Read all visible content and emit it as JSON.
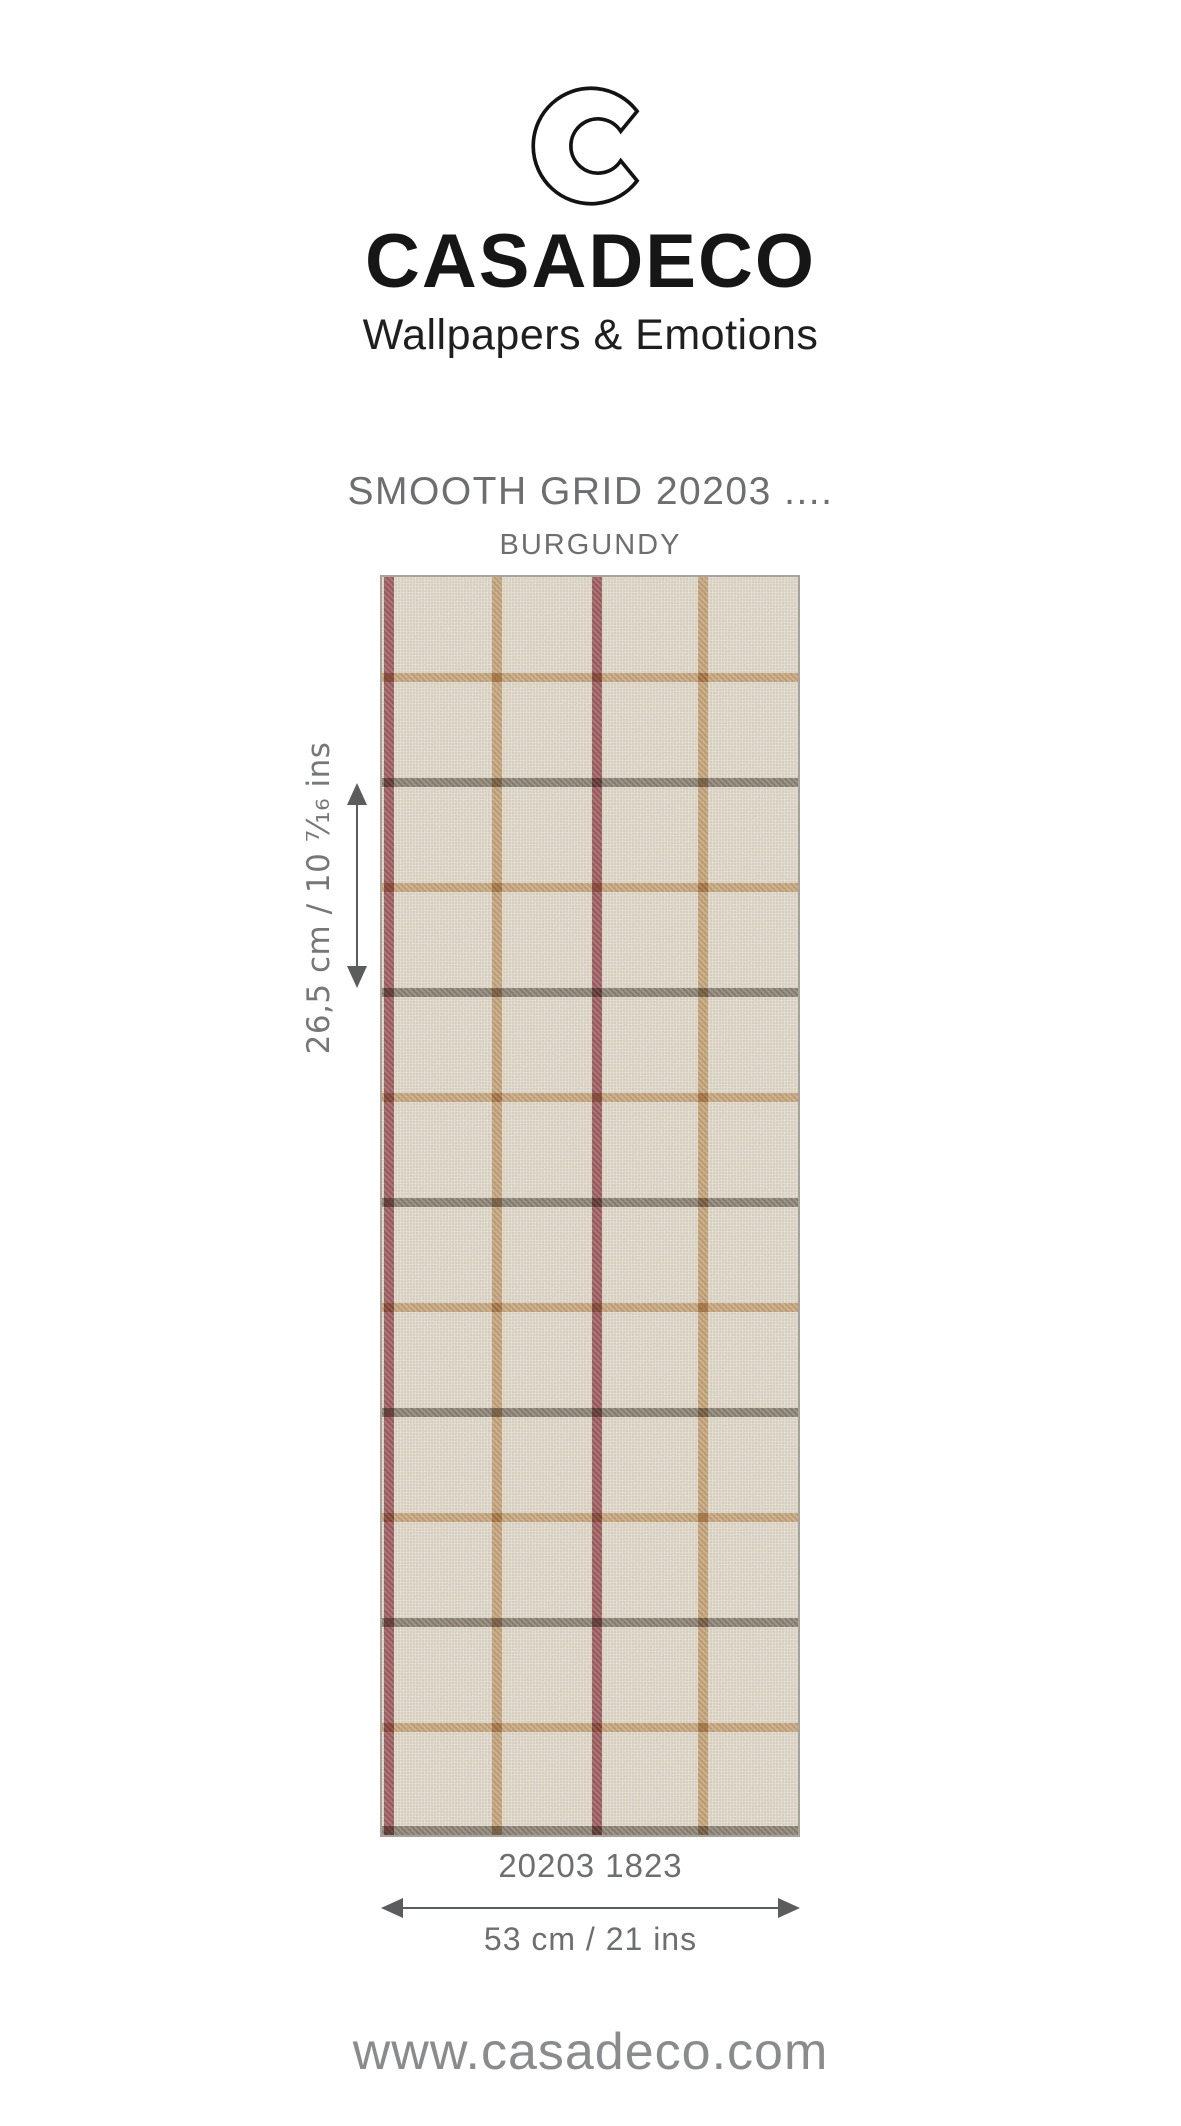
{
  "brand": {
    "name": "CASADECO",
    "tagline": "Wallpapers & Emotions"
  },
  "product": {
    "title": "SMOOTH GRID 20203 ....",
    "colorway": "BURGUNDY",
    "reference": "20203 1823"
  },
  "dimensions": {
    "height_label": "26,5 cm / 10 ⁷⁄₁₆ ins",
    "width_label": "53 cm / 21 ins"
  },
  "footer": {
    "website": "www.casadeco.com"
  },
  "colors": {
    "text_dark": "#161616",
    "text_gray": "#6d6e70",
    "label_gray": "#76777a",
    "annotation": "#5b5c5e",
    "website_gray": "#8a8b8d",
    "swatch_background": "#e9e2d4",
    "swatch_border": "#a7a39b"
  },
  "swatch": {
    "stripe_width": 10,
    "stripe_height": 9,
    "vertical_stripes": [
      {
        "name": "burgundy",
        "color": "#a3585f",
        "x": 2
      },
      {
        "name": "tan",
        "color": "#d2ad80",
        "x": 110
      },
      {
        "name": "burgundy",
        "color": "#a3585f",
        "x": 210
      },
      {
        "name": "tan",
        "color": "#d2ad80",
        "x": 316
      }
    ],
    "horizontal_stripes": [
      {
        "name": "tan",
        "color": "#d4af82",
        "y": 96
      },
      {
        "name": "grey",
        "color": "#8d8476",
        "y": 201
      },
      {
        "name": "tan",
        "color": "#d4af82",
        "y": 306
      },
      {
        "name": "grey",
        "color": "#8d8476",
        "y": 411
      },
      {
        "name": "tan",
        "color": "#d4af82",
        "y": 516
      },
      {
        "name": "grey",
        "color": "#8d8476",
        "y": 621
      },
      {
        "name": "tan",
        "color": "#d4af82",
        "y": 726
      },
      {
        "name": "grey",
        "color": "#8d8476",
        "y": 831
      },
      {
        "name": "tan",
        "color": "#d4af82",
        "y": 936
      },
      {
        "name": "grey",
        "color": "#8d8476",
        "y": 1041
      },
      {
        "name": "tan",
        "color": "#d4af82",
        "y": 1146
      },
      {
        "name": "grey",
        "color": "#8d8476",
        "y": 1249
      }
    ]
  }
}
